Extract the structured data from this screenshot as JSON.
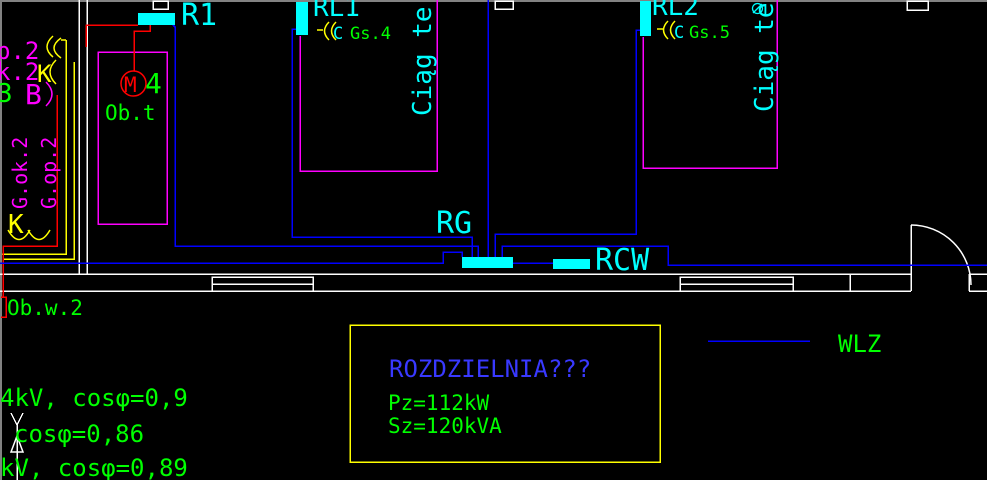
{
  "palette": {
    "background": "#000000",
    "wire_blue": "#0000ff",
    "cyan": "#00ffff",
    "magenta": "#ff00ff",
    "red": "#ff0000",
    "green": "#00ff00",
    "yellow": "#ffff00",
    "white": "#ffffff",
    "title_blue": "#3939ff",
    "border_gray": "#828282"
  },
  "boards": {
    "r1": "R1",
    "rl1": "RL1",
    "rl2": "RL2",
    "rg": "RG",
    "rcw": "RCW"
  },
  "circuits": {
    "gs4": "Gs.4",
    "gs5": "Gs.5",
    "c1": "C",
    "c2": "C",
    "motor": "M",
    "motor_num": "4"
  },
  "rooms": {
    "corridor1": "Ciąg te",
    "corridor2": "Ciąg te",
    "obt": "Ob.t",
    "obw2": "Ob.w.2",
    "gok2": "G.ok.2",
    "gop2": "G.op.2"
  },
  "left_labels": {
    "p2": "p.2",
    "k2": "k.2",
    "num3": "3",
    "b": "B",
    "k_top": "K",
    "k_bottom": "K"
  },
  "legend": {
    "wlz": "WLZ"
  },
  "info_box": {
    "title": "ROZDZIELNIA???",
    "line1": "Pz=112kW",
    "line2": "Sz=120kVA"
  },
  "notes": [
    "4kV, cosφ=0,9",
    "cosφ=0,86",
    "kV, cosφ=0,89"
  ]
}
